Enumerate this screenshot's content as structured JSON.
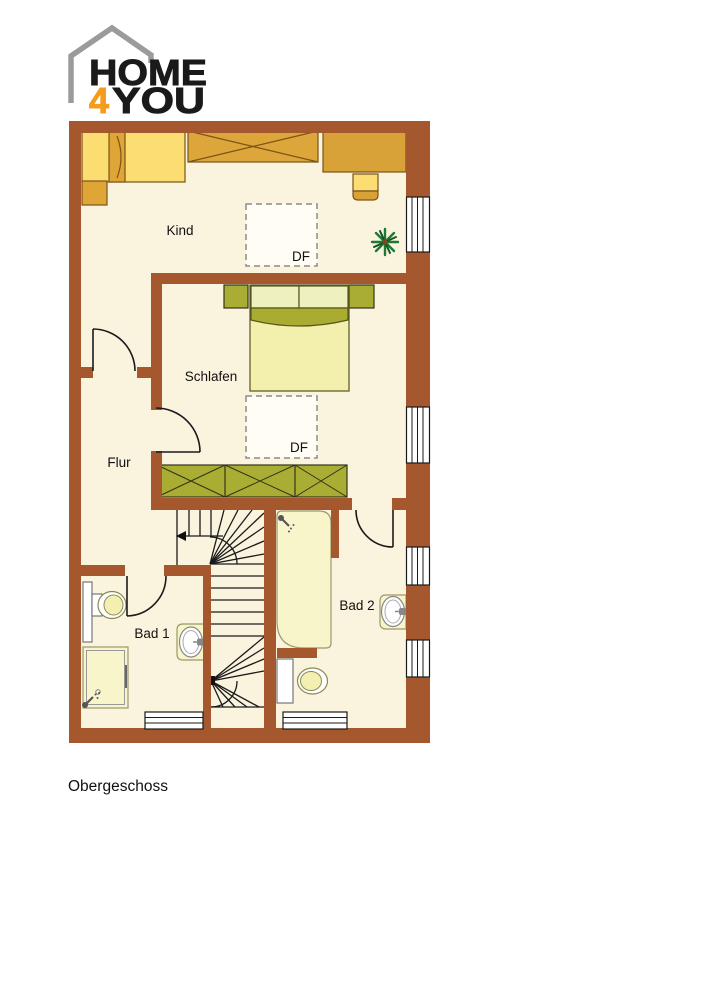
{
  "logo": {
    "word_top": "HOME",
    "accent_digit": "4",
    "word_bottom": "YOU"
  },
  "plan": {
    "floor_label": "Obergeschoss",
    "rooms": [
      {
        "id": "kind",
        "label": "Kind"
      },
      {
        "id": "schlafen",
        "label": "Schlafen"
      },
      {
        "id": "flur",
        "label": "Flur"
      },
      {
        "id": "bad1",
        "label": "Bad 1"
      },
      {
        "id": "bad2",
        "label": "Bad 2"
      }
    ],
    "roof_windows": [
      {
        "room": "kind",
        "label": "DF"
      },
      {
        "room": "schlafen",
        "label": "DF"
      }
    ]
  },
  "icons": {
    "logo-house-icon": "gray open house outline",
    "plant-icon": "green starburst potted plant (top view)",
    "shower-head-icon": "shower head with spray dots",
    "stair-direction-arrow": "left pointing arrow on stair tread",
    "roof-window": "dashed square (Dachfenster)"
  },
  "colors": {
    "wall": "#A5582E",
    "floor": "#FAF3DE",
    "furniture_tan": "#DCA63B",
    "furniture_yellow": "#FBDD72",
    "furniture_mustard": "#DFA637",
    "furniture_olive": "#A9AD33",
    "bed_pale": "#F2F0AC",
    "fixture_pale": "#F8F5CB",
    "fixture_white": "#FFFFFF",
    "plant_green": "#1F7A33",
    "logo_gray": "#9C9B9B",
    "logo_orange": "#F59C1C",
    "text": "#1A1A1A"
  }
}
